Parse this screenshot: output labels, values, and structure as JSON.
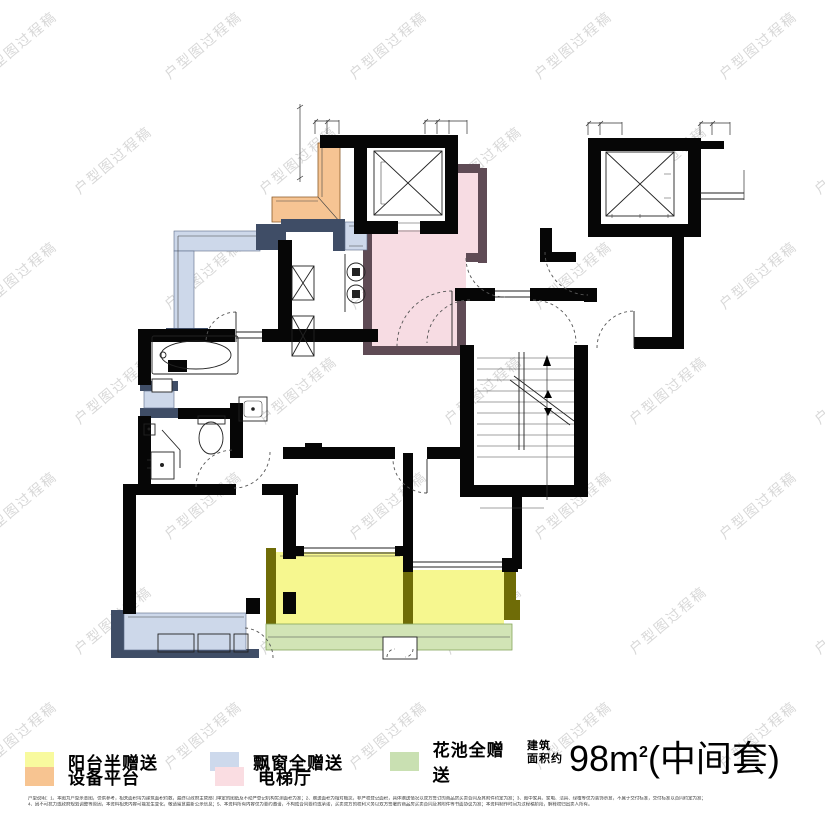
{
  "watermark": {
    "text": "户型图过程稿",
    "color": "#d8d8d8"
  },
  "legend": {
    "items": [
      {
        "label": "阳台半赠送",
        "color": "#f8fa9e"
      },
      {
        "label": "飘窗全赠送",
        "color": "#cdd9ec"
      },
      {
        "label": "花池全赠送",
        "color": "#c9e0b2"
      },
      {
        "label": "设备平台",
        "color": "#f7c491"
      },
      {
        "label": "电梯厅",
        "color": "#fadde2"
      }
    ]
  },
  "area_label": {
    "prefix_line1": "建筑",
    "prefix_line2": "面积约",
    "value": "98m",
    "exponent": "2",
    "suite": "(中间套)"
  },
  "plan": {
    "colors": {
      "yellow": "#f6f78f",
      "blue": "#cdd8ea",
      "green": "#d2e4b6",
      "orange": "#f6c493",
      "pink": "#f7dce3",
      "olive": "#6f6c07",
      "slate": "#3f4d66",
      "maroon": "#5f4b55"
    },
    "features": {
      "elevator_left": "电梯",
      "elevator_right": "电梯",
      "stairs": "楼梯",
      "elevator_hall": "电梯厅",
      "equipment_platform": "设备平台",
      "balcony": "阳台",
      "bay_window": "飘窗",
      "flower_bed": "花池"
    }
  },
  "disclaimer": {
    "line1": "户型说明：1、本图为户型示意图，仅供参考，相关面积均为建筑面积约数，最终以政府主管部门审定的图纸及不动产登记机构实测面积为准；2、赠送面积为相对概念，非产权登记面积，具体赠送情况以双方签订的商品房买卖合同及其附件约定为准；3、图中家具、家电、洁具、绿植等仅为装饰示意，不属于交付标准，交付标准以合同约定为准；",
    "line2": "4、因不可抗力或政府规划调整等原因，本资料相关内容可能发生变化，敬请留意最新公示信息；5、本资料所有内容仅为要约邀请，不构成合同要约或承诺，买卖双方的权利义务以双方签署的商品房买卖合同及其附件等书面协议为准；本资料制作时间为过程稿阶段，解释权归出卖人所有。"
  }
}
